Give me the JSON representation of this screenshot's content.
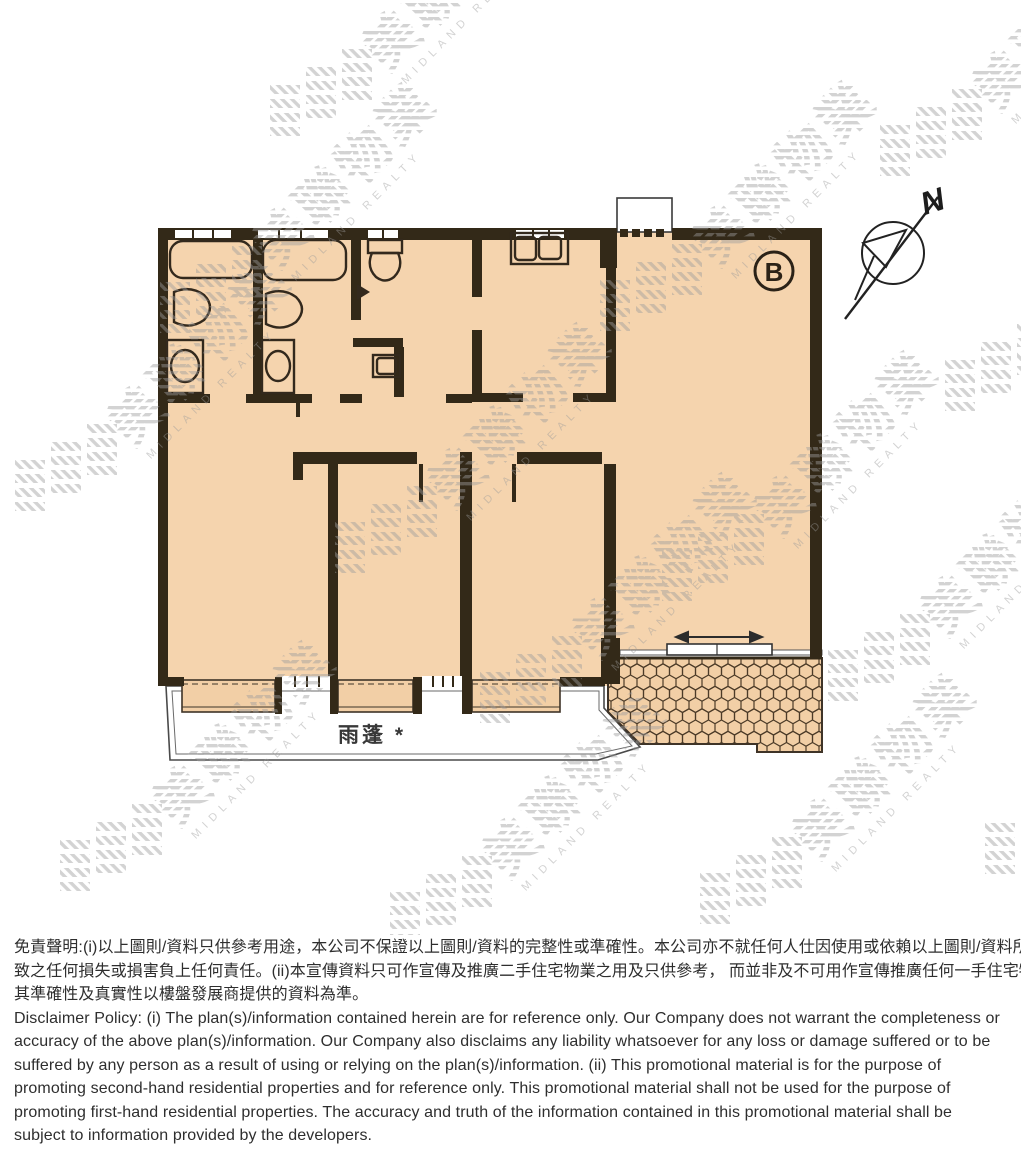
{
  "floor_plan": {
    "unit_label": "B",
    "compass_label": "N",
    "canopy_label": "雨蓬 *"
  },
  "watermark": {
    "name_zh": "美聯物業",
    "name_en": "MIDLAND REALTY",
    "color": "#9e9e9e"
  },
  "colors": {
    "floor": "#f5d4ae",
    "wall": "#332918",
    "tile_line": "#4c3b28",
    "disclaimer_text": "#2e2e2e"
  },
  "disclaimer": {
    "zh": [
      "免責聲明:(i)以上圖則/資料只供參考用途，本公司不保證以上圖則/資料的完整性或準確性。本公司亦不就任何人仕因使用或依賴以上圖則/資料所引",
      "致之任何損失或損害負上任何責任。(ii)本宣傳資料只可作宣傳及推廣二手住宅物業之用及只供參考， 而並非及不可用作宣傳推廣任何一手住宅物業，",
      "其準確性及真實性以樓盤發展商提供的資料為準。"
    ],
    "en": [
      "Disclaimer Policy: (i) The plan(s)/information contained herein are for reference only. Our Company does not warrant the completeness or",
      "accuracy of the above plan(s)/information. Our Company also disclaims any liability whatsoever for any loss or damage suffered or to be",
      "suffered by any person as a result of using or relying on the plan(s)/information. (ii) This promotional material is for the purpose of",
      "promoting second-hand residential properties and for reference only. This promotional material shall not be used for the purpose of",
      "promoting first-hand residential properties. The accuracy and truth of the information contained in this promotional material shall be",
      "subject to information provided by the developers."
    ]
  }
}
